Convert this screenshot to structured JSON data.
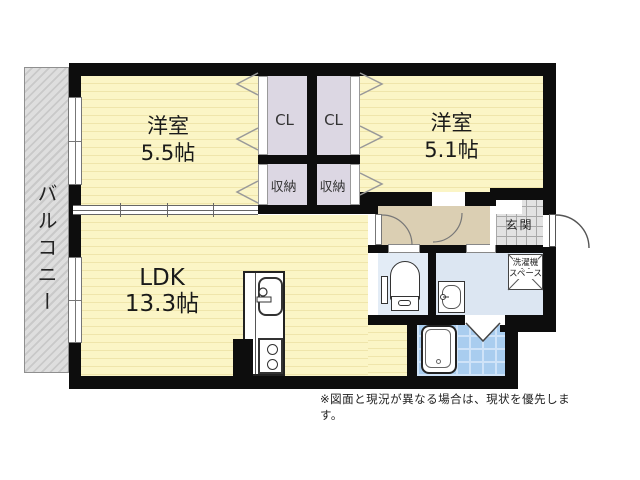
{
  "plan": {
    "balcony": "バルコニー",
    "room1": {
      "name": "洋室",
      "size": "5.5帖"
    },
    "room2": {
      "name": "洋室",
      "size": "5.1帖"
    },
    "ldk": {
      "name": "LDK",
      "size": "13.3帖"
    },
    "closet_left": "CL",
    "closet_right": "CL",
    "storage_left": "収納",
    "storage_right": "収納",
    "entrance": "玄関",
    "laundry": {
      "line1": "洗濯機",
      "line2": "スペース"
    },
    "note": "※図面と現況が異なる場合は、現状を優先します。"
  },
  "colors": {
    "room_yellow": "#FBF5C6",
    "room_stripe": "#EFE5AB",
    "closet_lavender": "#DCD7E3",
    "hallway_tan": "#DBCFB3",
    "toilet_blue": "#E3ECF6",
    "washroom_blue": "#DCE6F2",
    "bath_blue": "#A9CDEF",
    "bath_grid": "#CFE3F8",
    "entrance_tile": "#E2E2E2",
    "balcony_gray": "#D8D8D8",
    "wall": "#0D0D0D"
  }
}
